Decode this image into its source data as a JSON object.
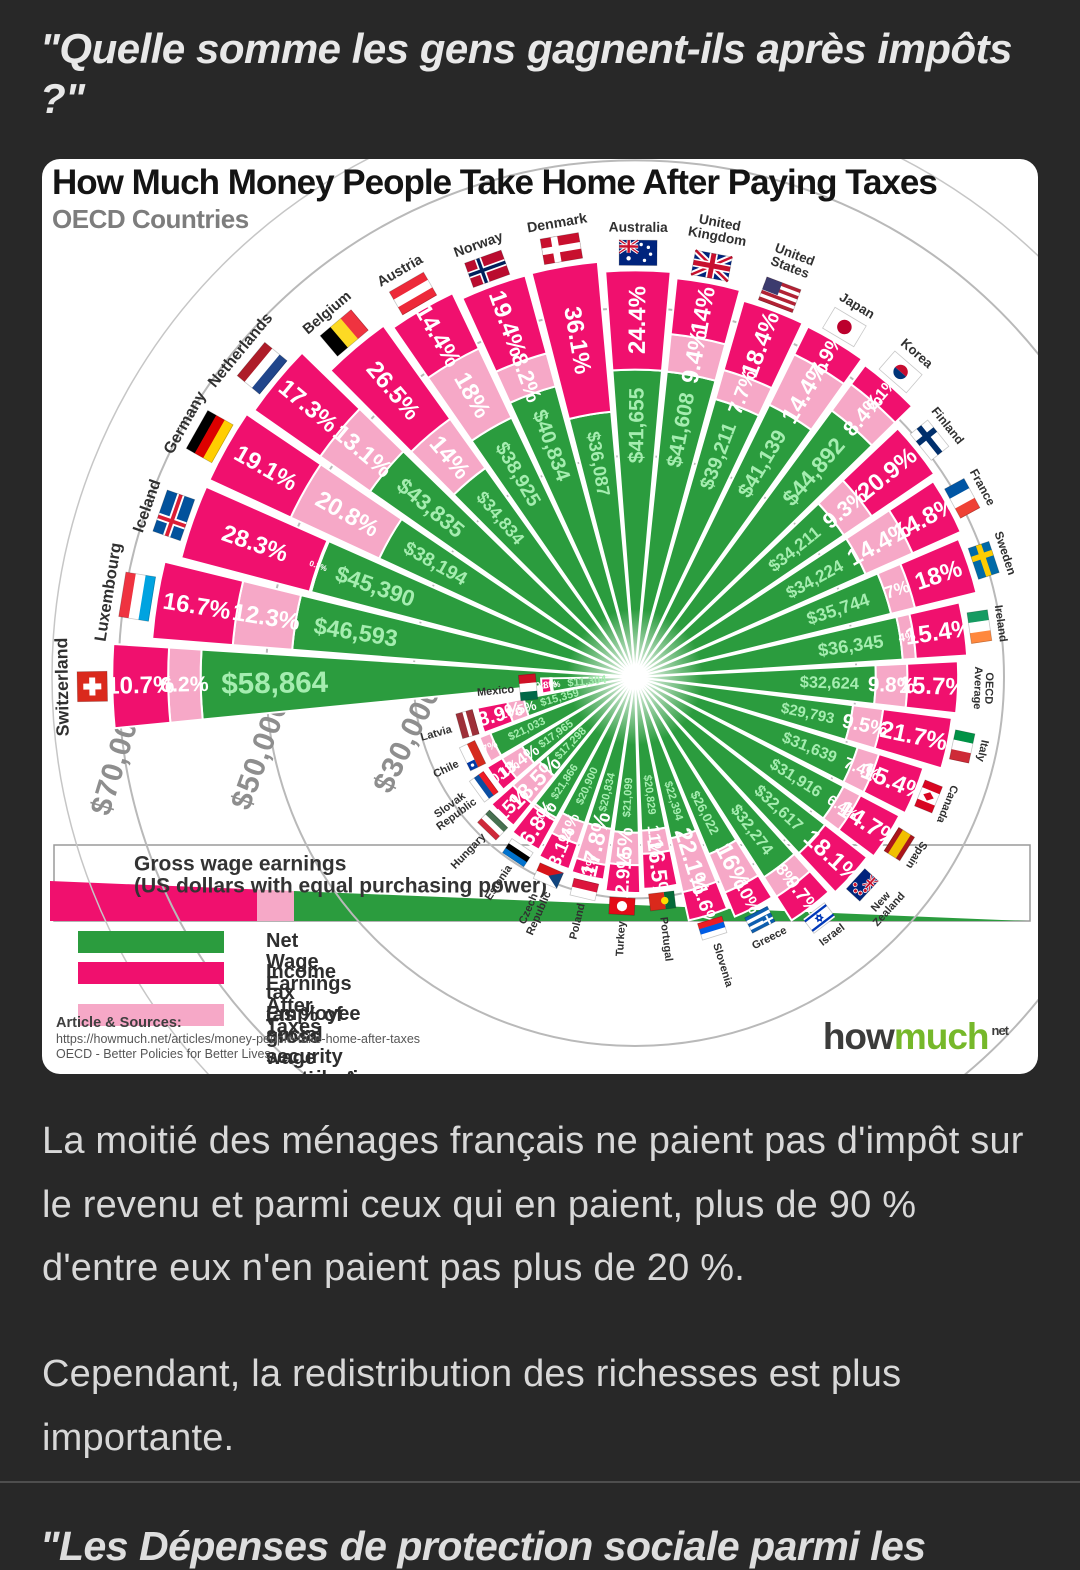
{
  "page": {
    "title": "\"Quelle somme les gens gagnent-ils après impôts ?\"",
    "paragraphs": [
      "La moitié des ménages français ne paient pas d'impôt sur le revenu et parmi ceux qui en paient, plus de 90 % d'entre eux n'en paient pas plus de 20 %.",
      "Cependant, la redistribution des richesses est plus importante."
    ],
    "footer_heading": "\"Les Dépenses de protection sociale parmi les"
  },
  "chart_data": {
    "type": "radial-bar",
    "title": "How Much Money People Take Home After Paying Taxes",
    "subtitle": "OECD Countries",
    "colors": {
      "magenta": "#F0106E",
      "pink": "#F6A8C7",
      "green": "#2B9C3E",
      "green_text": "#A5EDB0",
      "ring": "#B9B9B9",
      "page_bg": "#282828",
      "logo_green": "#76B82A"
    },
    "rings": [
      {
        "label": "$30,000",
        "value": 30000
      },
      {
        "label": "$50,000",
        "value": 50000
      },
      {
        "label": "$70,000",
        "value": 70000
      }
    ],
    "legend": {
      "box_title": "Gross wage earnings",
      "box_subtitle": "(US dollars with equal purchasing power)",
      "items": [
        {
          "label": "Net Wage Earnings After Taxes",
          "sub": "",
          "color_key": "green"
        },
        {
          "label": "Income tax",
          "sub": "(as % of gross wage earnings)",
          "color_key": "magenta"
        },
        {
          "label": "Employee social security contributions",
          "sub": "(as % of gross wage earnings)",
          "color_key": "pink"
        }
      ]
    },
    "sources": {
      "title": "Article & Sources:",
      "url": "https://howmuch.net/articles/money-people-take-home-after-taxes",
      "org": "OECD - Better Policies for Better Lives"
    },
    "logo": {
      "how": "how",
      "much": "much",
      "tld": "net"
    },
    "countries": [
      {
        "name": [
          "Switzerland"
        ],
        "income_tax": "10.7%",
        "social_security": "6.2%",
        "net": "$58,864",
        "flag": {
          "t": "swiss"
        }
      },
      {
        "name": [
          "Luxembourg"
        ],
        "income_tax": "16.7%",
        "social_security": "12.3%",
        "net": "$46,593",
        "flag": {
          "d": "h",
          "c": [
            "#EF3340",
            "#FFFFFF",
            "#00A3E0"
          ]
        }
      },
      {
        "name": [
          "Iceland"
        ],
        "income_tax": "28.3%",
        "social_security": "0.3%",
        "net": "$45,390",
        "flag": {
          "t": "nordic",
          "bg": "#02529C",
          "o": "#FFFFFF",
          "i": "#DC1E35"
        }
      },
      {
        "name": [
          "Germany"
        ],
        "income_tax": "19.1%",
        "social_security": "20.8%",
        "net": "$38,194",
        "flag": {
          "d": "h",
          "c": [
            "#000000",
            "#DD0000",
            "#FFCE00"
          ]
        }
      },
      {
        "name": [
          "Netherlands"
        ],
        "income_tax": "17.3%",
        "social_security": "13.1%",
        "net": "$43,835",
        "flag": {
          "d": "h",
          "c": [
            "#AE1C28",
            "#FFFFFF",
            "#21468B"
          ]
        }
      },
      {
        "name": [
          "Belgium"
        ],
        "income_tax": "26.5%",
        "social_security": "14%",
        "net": "$34,834",
        "flag": {
          "d": "v",
          "c": [
            "#000000",
            "#FDDA24",
            "#EF3340"
          ]
        }
      },
      {
        "name": [
          "Austria"
        ],
        "income_tax": "14.4%",
        "social_security": "18%",
        "net": "$38,925",
        "flag": {
          "d": "h",
          "c": [
            "#ED2939",
            "#FFFFFF",
            "#ED2939"
          ]
        }
      },
      {
        "name": [
          "Norway"
        ],
        "income_tax": "19.4%",
        "social_security": "8.2%",
        "net": "$40,834",
        "flag": {
          "t": "nordic",
          "bg": "#BA0C2F",
          "o": "#FFFFFF",
          "i": "#00205B"
        }
      },
      {
        "name": [
          "Denmark"
        ],
        "income_tax": "36.1%",
        "social_security": null,
        "net": "$36,087",
        "flag": {
          "t": "nordic",
          "bg": "#C8102E",
          "o": "#FFFFFF"
        }
      },
      {
        "name": [
          "Australia"
        ],
        "income_tax": "24.4%",
        "social_security": null,
        "net": "$41,655",
        "flag": {
          "t": "aus"
        }
      },
      {
        "name": [
          "United",
          "Kingdom"
        ],
        "income_tax": "14%",
        "social_security": "9.4%",
        "net": "$41,608",
        "flag": {
          "t": "uj"
        }
      },
      {
        "name": [
          "United",
          "States"
        ],
        "income_tax": "18.4%",
        "social_security": "7.7%",
        "net": "$39,211",
        "flag": {
          "t": "usa"
        }
      },
      {
        "name": [
          "Japan"
        ],
        "income_tax": "7.9%",
        "social_security": "14.4%",
        "net": "$41,139",
        "flag": {
          "t": "dot",
          "bg": "#FFFFFF",
          "c": "#BC002D"
        }
      },
      {
        "name": [
          "Korea"
        ],
        "income_tax": "6.1%",
        "social_security": "8.4%",
        "net": "$44,892",
        "flag": {
          "t": "kor"
        }
      },
      {
        "name": [
          "Finland"
        ],
        "income_tax": "20.9%",
        "social_security": "9.3%",
        "net": "$34,211",
        "flag": {
          "t": "nordic",
          "bg": "#FFFFFF",
          "o": "#002F6C"
        }
      },
      {
        "name": [
          "France"
        ],
        "income_tax": "14.8%",
        "social_security": "14.4%",
        "net": "$34,224",
        "flag": {
          "d": "v",
          "c": [
            "#0055A4",
            "#FFFFFF",
            "#EF4135"
          ]
        }
      },
      {
        "name": [
          "Sweden"
        ],
        "income_tax": "18%",
        "social_security": "7%",
        "net": "$35,744",
        "flag": {
          "t": "nordic",
          "bg": "#006AA7",
          "o": "#FECC02"
        }
      },
      {
        "name": [
          "Ireland"
        ],
        "income_tax": "15.4%",
        "social_security": "4%",
        "net": "$36,345",
        "flag": {
          "d": "v",
          "c": [
            "#169B62",
            "#FFFFFF",
            "#FF883E"
          ]
        }
      },
      {
        "name": [
          "OECD",
          "Average"
        ],
        "income_tax": "15.7%",
        "social_security": "9.8%",
        "net": "$32,624",
        "flag": null
      },
      {
        "name": [
          "Italy"
        ],
        "income_tax": "21.7%",
        "social_security": "9.5%",
        "net": "$29,793",
        "flag": {
          "d": "v",
          "c": [
            "#009246",
            "#FFFFFF",
            "#CE2B37"
          ]
        }
      },
      {
        "name": [
          "Canada"
        ],
        "income_tax": "15.4%",
        "social_security": "7.4%",
        "net": "$31,639",
        "flag": {
          "t": "can"
        }
      },
      {
        "name": [
          "Spain"
        ],
        "income_tax": "14.7%",
        "social_security": "6.4%",
        "net": "$31,916",
        "flag": {
          "d": "h",
          "c": [
            "#AA151B",
            "#F1BF00",
            "#AA151B"
          ],
          "w": [
            1,
            2,
            1
          ]
        }
      },
      {
        "name": [
          "New",
          "Zealand"
        ],
        "income_tax": "18.1%",
        "social_security": null,
        "net": "$32,617",
        "flag": {
          "t": "nzl"
        }
      },
      {
        "name": [
          "Israel"
        ],
        "income_tax": "9.7%",
        "social_security": "8%",
        "net": "$32,274",
        "flag": {
          "t": "isr"
        }
      },
      {
        "name": [
          "Greece"
        ],
        "income_tax": "10%",
        "social_security": "16%",
        "net": "$26,022",
        "flag": {
          "t": "gre"
        }
      },
      {
        "name": [
          "Slovenia"
        ],
        "income_tax": "11.6%",
        "social_security": "22.1%",
        "net": "$22,394",
        "flag": {
          "d": "h",
          "c": [
            "#FFFFFF",
            "#005CE5",
            "#ED1C24"
          ]
        }
      },
      {
        "name": [
          "Portugal"
        ],
        "income_tax": "16.5%",
        "social_security": "11%",
        "net": "$20,829",
        "flag": {
          "t": "por"
        }
      },
      {
        "name": [
          "Turkey"
        ],
        "income_tax": "12.9%",
        "social_security": "15%",
        "net": "$21,099",
        "flag": {
          "t": "dot",
          "bg": "#E30A17",
          "c": "#FFFFFF"
        }
      },
      {
        "name": [
          "Poland"
        ],
        "income_tax": "7.2%",
        "social_security": "17.8%",
        "net": "$20,834",
        "flag": {
          "d": "h",
          "c": [
            "#FFFFFF",
            "#DC143C"
          ]
        }
      },
      {
        "name": [
          "Czech",
          "Republic"
        ],
        "income_tax": "13.1%",
        "social_security": "11%",
        "net": "$20,900",
        "flag": {
          "t": "cze"
        }
      },
      {
        "name": [
          "Estonia"
        ],
        "income_tax": "16.8%",
        "social_security": "1.6%",
        "net": "$21,866",
        "flag": {
          "d": "h",
          "c": [
            "#0072CE",
            "#000000",
            "#FFFFFF"
          ]
        }
      },
      {
        "name": [
          "Hungary"
        ],
        "income_tax": "15%",
        "social_security": "18.5%",
        "net": "$17,298",
        "flag": {
          "d": "h",
          "c": [
            "#CE2939",
            "#FFFFFF",
            "#477050"
          ]
        }
      },
      {
        "name": [
          "Slovak",
          "Republic"
        ],
        "income_tax": "10.1%",
        "social_security": "13.4%",
        "net": "$17,965",
        "flag": {
          "d": "h",
          "c": [
            "#FFFFFF",
            "#0B4EA2",
            "#EE1C25"
          ]
        }
      },
      {
        "name": [
          "Chile"
        ],
        "income_tax": null,
        "social_security": "7%",
        "net": "$21,033",
        "flag": {
          "t": "chi"
        }
      },
      {
        "name": [
          "Latvia"
        ],
        "income_tax": "18.9%",
        "social_security": "10.5%",
        "net": "$15,359",
        "flag": {
          "d": "h",
          "c": [
            "#9E3039",
            "#FFFFFF",
            "#9E3039"
          ],
          "w": [
            2,
            1,
            2
          ]
        }
      },
      {
        "name": [
          "Mexico"
        ],
        "income_tax": "9.8%",
        "social_security": "1.4%",
        "net": "$11,304",
        "flag": {
          "d": "v",
          "c": [
            "#006847",
            "#FFFFFF",
            "#CE1126"
          ]
        }
      }
    ]
  }
}
